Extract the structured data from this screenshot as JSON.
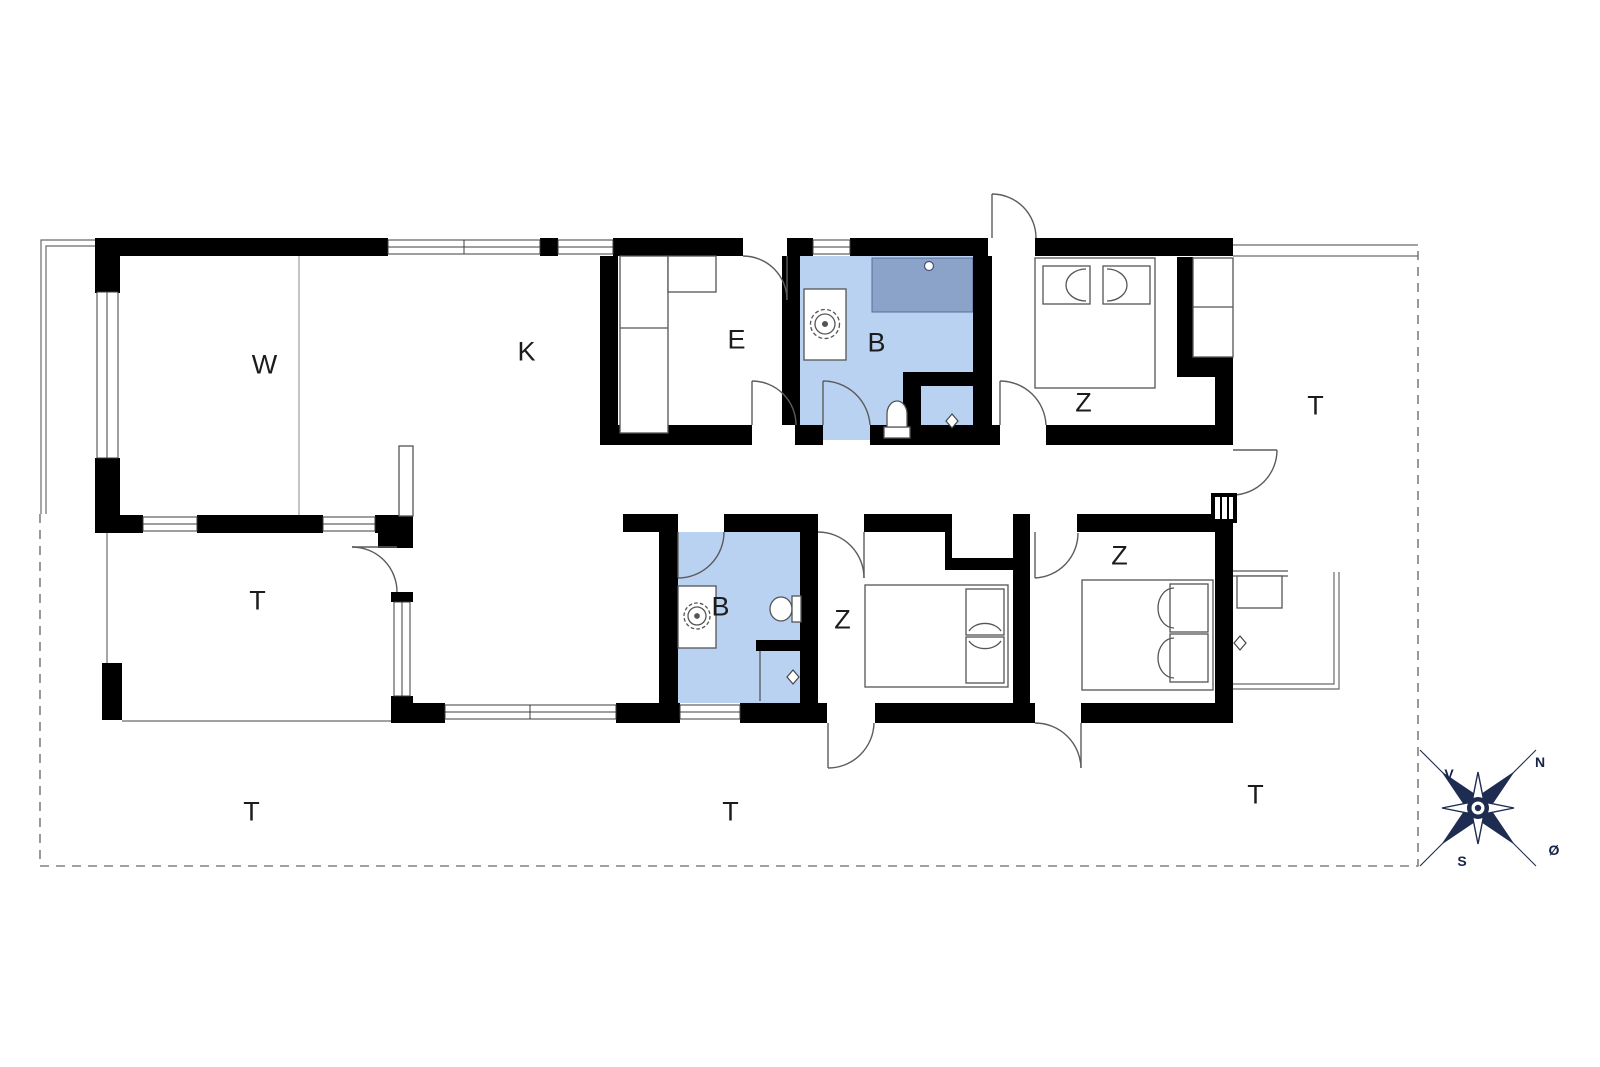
{
  "rooms": {
    "living": "W",
    "kitchen": "K",
    "entry": "E",
    "bath_top": "B",
    "bath_bottom": "B",
    "bed_top": "Z",
    "bed_middle": "Z",
    "bed_right": "Z",
    "terrace_right": "T",
    "terrace_inner": "T",
    "terrace_bottom_left": "T",
    "terrace_bottom_middle": "T",
    "terrace_bottom_right": "T"
  },
  "compass": {
    "north": "N",
    "west": "V",
    "south": "S",
    "east": "Ø"
  },
  "colors": {
    "wall": "#000000",
    "bath_floor": "#b9d2f1",
    "shower_mat": "#8ba3c9",
    "compass_navy": "#1d2c50",
    "fixture_line": "#555555",
    "boundary_dash": "#808080"
  }
}
